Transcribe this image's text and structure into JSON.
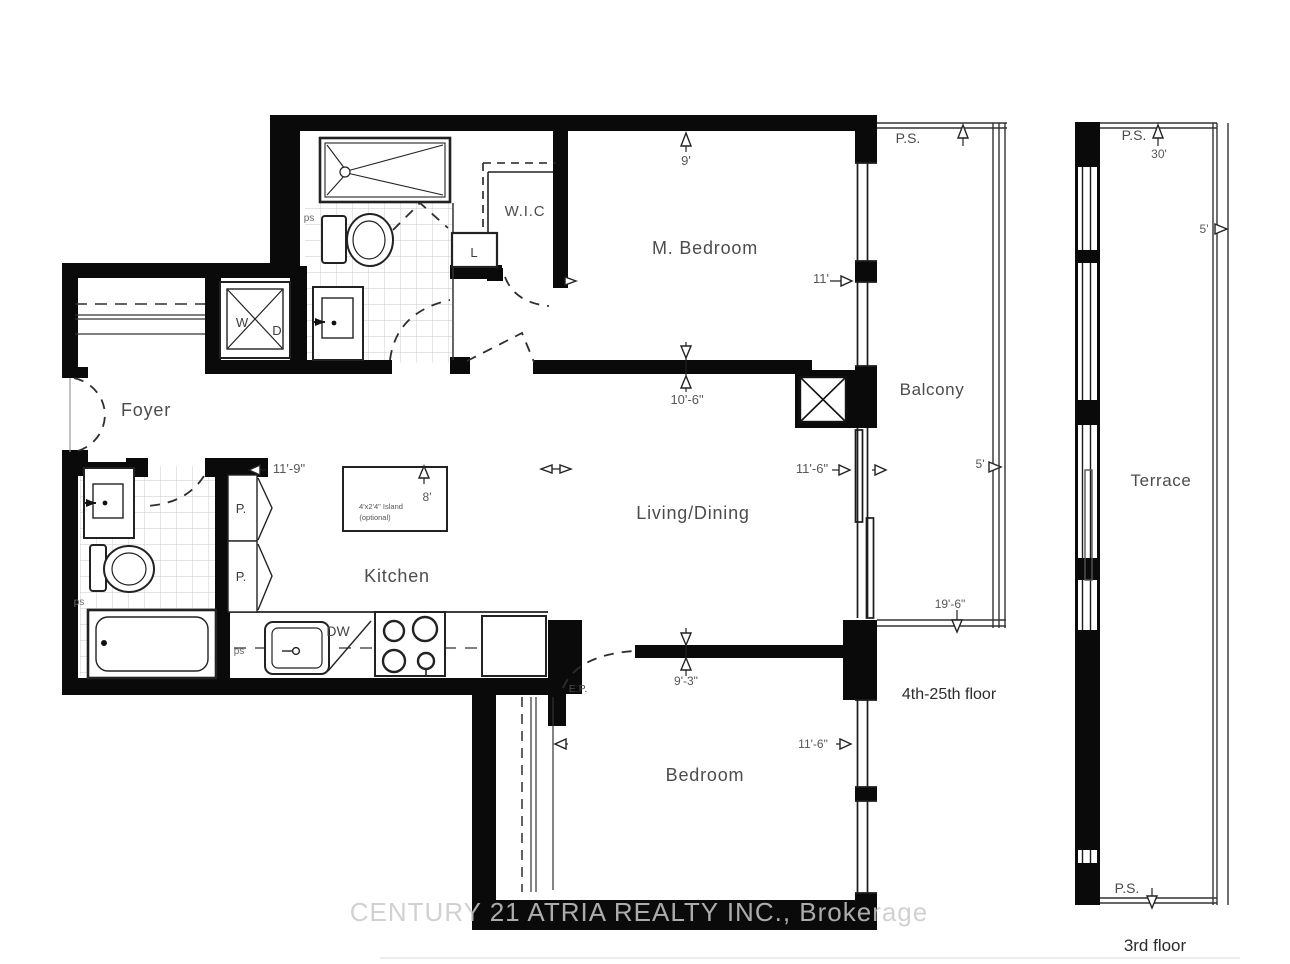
{
  "plan": {
    "rooms": {
      "foyer": "Foyer",
      "wic": "W.I.C",
      "linen": "L",
      "m_bedroom": "M. Bedroom",
      "living_dining": "Living/Dining",
      "kitchen": "Kitchen",
      "bedroom": "Bedroom",
      "balcony": "Balcony",
      "terrace": "Terrace"
    },
    "dims": {
      "mbed_width": "9'",
      "mbed_depth": "11'",
      "mbed_width2": "10'-6\"",
      "living_width": "11'-9\"",
      "living_depth": "11'-6\"",
      "island_length": "8'",
      "bedroom_width": "9'-3\"",
      "bedroom_depth": "11'-6\"",
      "balcony_depth": "5'",
      "balcony_length": "19'-6\"",
      "terrace_length": "30'",
      "terrace_depth": "5'"
    },
    "annos": {
      "ps_balcony": "P.S.",
      "ps_terrace_top": "P.S.",
      "ps_terrace_bottom": "P.S.",
      "washer": "W",
      "dryer": "D",
      "pantry_1": "P.",
      "pantry_2": "P.",
      "ps_bath1": "ps",
      "ps_bath2": "ps",
      "ps_kitchen": "ps",
      "dishwasher": "DW",
      "electrical_panel": "E.P.",
      "island_line1": "4'x2'4\" Island",
      "island_line2": "(optional)",
      "balcony_floors": "4th-25th floor",
      "terrace_floor": "3rd floor"
    },
    "watermark": "CENTURY 21 ATRIA REALTY INC., Brokerage"
  }
}
